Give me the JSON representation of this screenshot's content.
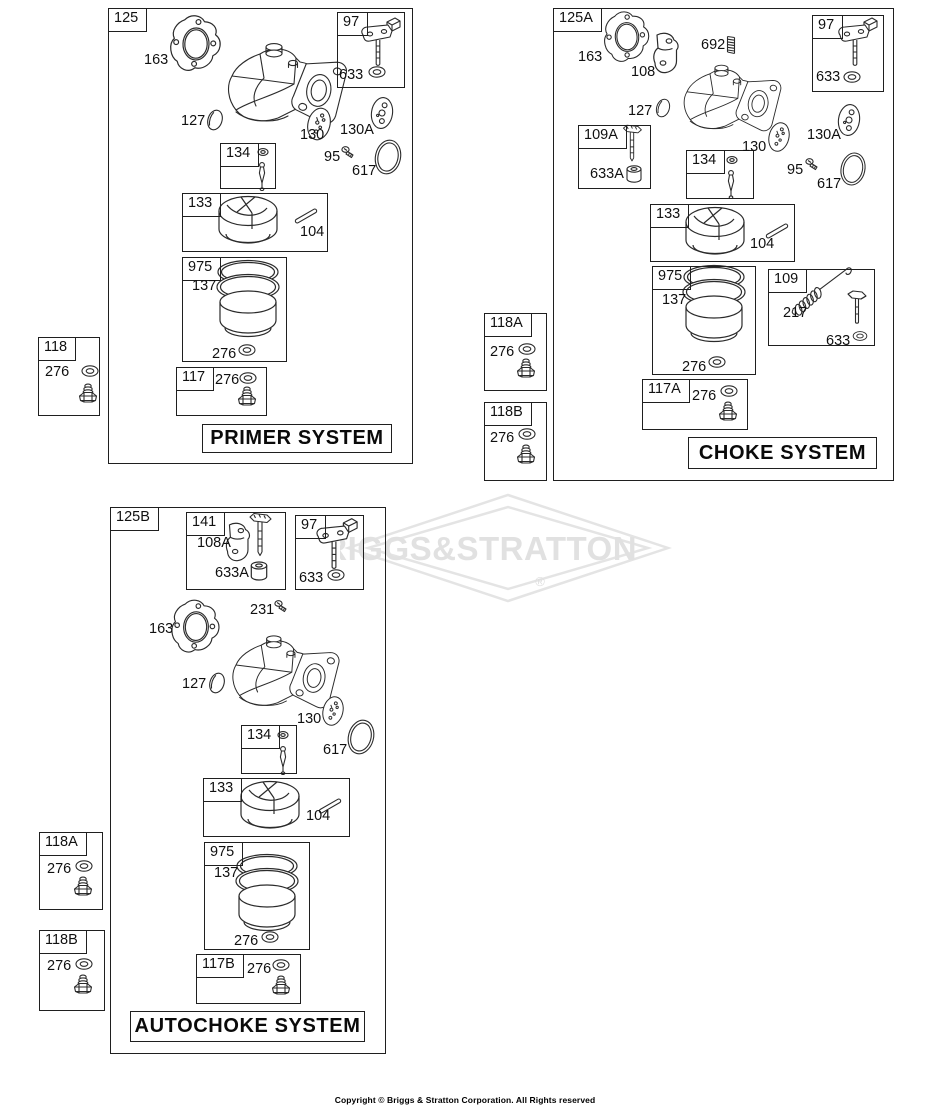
{
  "watermark": {
    "text": "BRIGGS&STRATTON",
    "registered": "®"
  },
  "copyright": "Copyright © Briggs & Stratton Corporation. All Rights reserved",
  "panels": {
    "primer": {
      "frame_label": "125",
      "title": "PRIMER SYSTEM",
      "box_labels": {
        "b97": "97",
        "b134": "134",
        "b133": "133",
        "b975": "975",
        "b117": "117",
        "b118": "118"
      },
      "callouts": [
        {
          "text": "163",
          "x": 144,
          "y": 52
        },
        {
          "text": "127",
          "x": 181,
          "y": 113
        },
        {
          "text": "130",
          "x": 300,
          "y": 127
        },
        {
          "text": "130A",
          "x": 340,
          "y": 122
        },
        {
          "text": "95",
          "x": 324,
          "y": 149
        },
        {
          "text": "617",
          "x": 352,
          "y": 163
        },
        {
          "text": "633",
          "x": 339,
          "y": 67
        },
        {
          "text": "104",
          "x": 300,
          "y": 224
        },
        {
          "text": "137",
          "x": 192,
          "y": 278
        },
        {
          "text": "276",
          "x": 212,
          "y": 346
        },
        {
          "text": "276",
          "x": 215,
          "y": 372
        },
        {
          "text": "276",
          "x": 45,
          "y": 364
        }
      ]
    },
    "choke": {
      "frame_label": "125A",
      "title": "CHOKE SYSTEM",
      "box_labels": {
        "b97": "97",
        "b109A": "109A",
        "b134": "134",
        "b133": "133",
        "b975": "975",
        "b109": "109",
        "b117A": "117A",
        "b118A": "118A",
        "b118B": "118B"
      },
      "callouts": [
        {
          "text": "163",
          "x": 578,
          "y": 49
        },
        {
          "text": "108",
          "x": 631,
          "y": 64
        },
        {
          "text": "692",
          "x": 701,
          "y": 37
        },
        {
          "text": "127",
          "x": 628,
          "y": 103
        },
        {
          "text": "130",
          "x": 742,
          "y": 139
        },
        {
          "text": "130A",
          "x": 807,
          "y": 127
        },
        {
          "text": "95",
          "x": 787,
          "y": 162
        },
        {
          "text": "617",
          "x": 817,
          "y": 176
        },
        {
          "text": "633",
          "x": 816,
          "y": 69
        },
        {
          "text": "633A",
          "x": 590,
          "y": 166
        },
        {
          "text": "104",
          "x": 750,
          "y": 236
        },
        {
          "text": "137",
          "x": 662,
          "y": 292
        },
        {
          "text": "276",
          "x": 682,
          "y": 359
        },
        {
          "text": "217",
          "x": 783,
          "y": 305
        },
        {
          "text": "633",
          "x": 826,
          "y": 333
        },
        {
          "text": "276",
          "x": 692,
          "y": 388
        },
        {
          "text": "276",
          "x": 490,
          "y": 344
        },
        {
          "text": "276",
          "x": 490,
          "y": 430
        }
      ]
    },
    "autochoke": {
      "frame_label": "125B",
      "title": "AUTOCHOKE SYSTEM",
      "box_labels": {
        "b141": "141",
        "b97": "97",
        "b134": "134",
        "b133": "133",
        "b975": "975",
        "b117B": "117B",
        "b118A": "118A",
        "b118B": "118B"
      },
      "callouts": [
        {
          "text": "108A",
          "x": 197,
          "y": 535
        },
        {
          "text": "633A",
          "x": 215,
          "y": 565
        },
        {
          "text": "633",
          "x": 299,
          "y": 570
        },
        {
          "text": "231",
          "x": 250,
          "y": 602
        },
        {
          "text": "163",
          "x": 149,
          "y": 621
        },
        {
          "text": "127",
          "x": 182,
          "y": 676
        },
        {
          "text": "130",
          "x": 297,
          "y": 711
        },
        {
          "text": "617",
          "x": 323,
          "y": 742
        },
        {
          "text": "104",
          "x": 306,
          "y": 808
        },
        {
          "text": "137",
          "x": 214,
          "y": 865
        },
        {
          "text": "276",
          "x": 234,
          "y": 933
        },
        {
          "text": "276",
          "x": 247,
          "y": 961
        },
        {
          "text": "276",
          "x": 47,
          "y": 861
        },
        {
          "text": "276",
          "x": 47,
          "y": 958
        }
      ]
    }
  }
}
